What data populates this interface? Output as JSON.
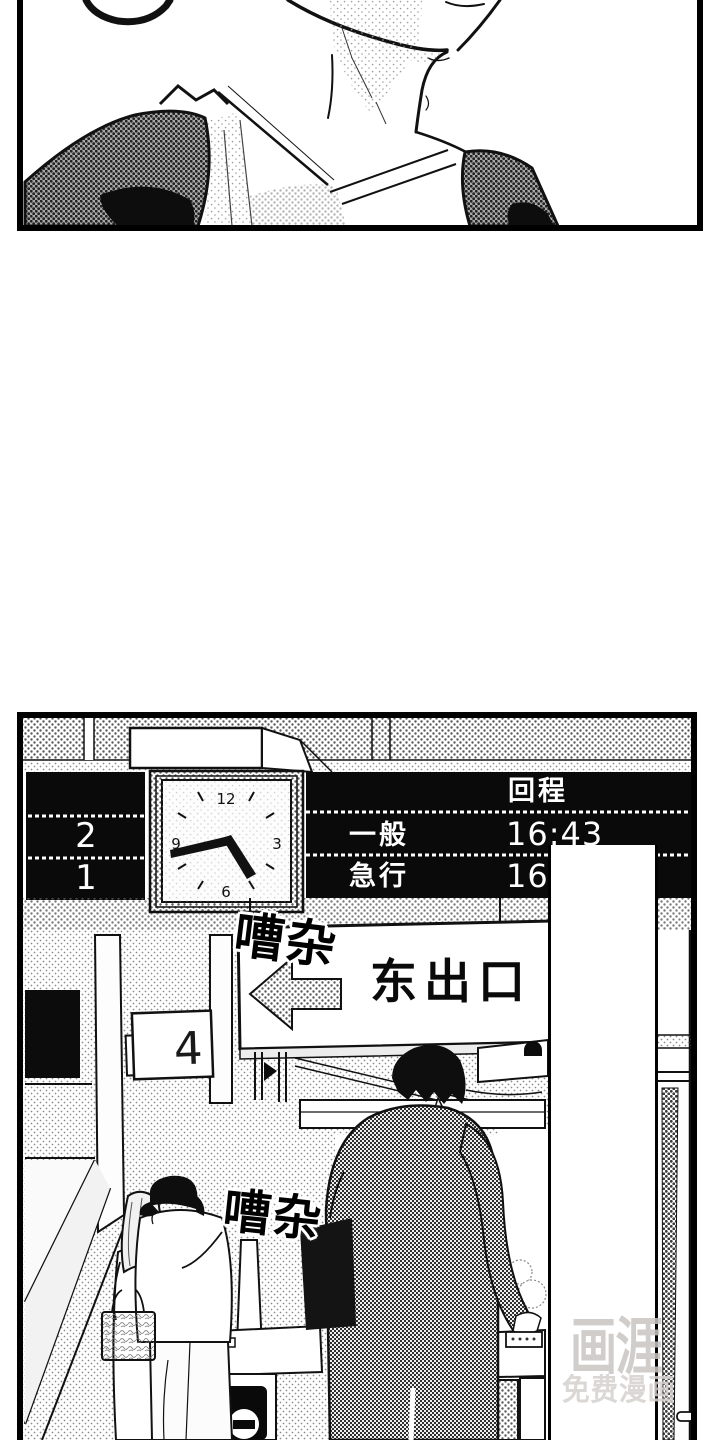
{
  "station_board": {
    "header": "回程",
    "platforms": [
      "2",
      "1"
    ],
    "rows": [
      {
        "label": "一般",
        "time": "16:43"
      },
      {
        "label": "急行",
        "time": "16"
      }
    ]
  },
  "clock": {
    "numerals": [
      "12",
      "3",
      "6",
      "9"
    ],
    "time_shown": "16:43"
  },
  "signs": {
    "exit": "东出口",
    "platform": "4"
  },
  "sfx": [
    {
      "text": "嘈杂"
    },
    {
      "text": "嘈杂"
    }
  ],
  "watermark": {
    "logo": "画涯",
    "tagline": "免费漫画"
  },
  "colors": {
    "ink": "#111111",
    "paper": "#ffffff",
    "board_bg": "#0a0a0a",
    "board_text": "#ffffff",
    "watermark_text": "#c8c4c1"
  }
}
